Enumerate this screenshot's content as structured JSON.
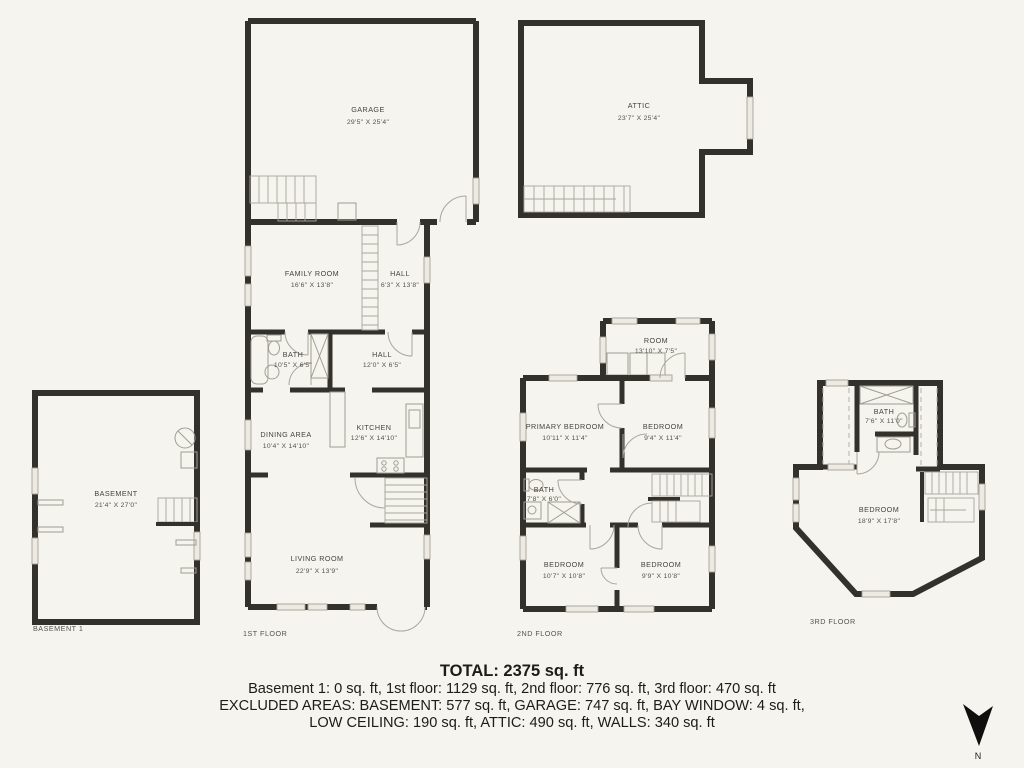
{
  "colors": {
    "background": "#f5f4ee",
    "wall": "#33312b",
    "fixture": "#a09e93",
    "window_fill": "#eceae1",
    "label_text": "#45443e"
  },
  "rooms": {
    "garage": {
      "name": "GARAGE",
      "dims": "29'5\" X 25'4\""
    },
    "attic": {
      "name": "ATTIC",
      "dims": "23'7\" X 25'4\""
    },
    "family_room": {
      "name": "FAMILY ROOM",
      "dims": "16'6\" X 13'8\""
    },
    "hall_upper": {
      "name": "HALL",
      "dims": "6'3\" X 13'8\""
    },
    "bath_1": {
      "name": "BATH",
      "dims": "10'5\" X 6'5\""
    },
    "hall_lower": {
      "name": "HALL",
      "dims": "12'0\" X 6'5\""
    },
    "dining": {
      "name": "DINING AREA",
      "dims": "10'4\" X 14'10\""
    },
    "kitchen": {
      "name": "KITCHEN",
      "dims": "12'6\" X 14'10\""
    },
    "living": {
      "name": "LIVING ROOM",
      "dims": "22'9\" X 13'9\""
    },
    "basement": {
      "name": "BASEMENT",
      "dims": "21'4\" X 27'0\""
    },
    "room_2f": {
      "name": "ROOM",
      "dims": "13'10\" X 7'5\""
    },
    "primary_bedroom": {
      "name": "PRIMARY BEDROOM",
      "dims": "10'11\" X 11'4\""
    },
    "bedroom_2f_ne": {
      "name": "BEDROOM",
      "dims": "9'4\" X 11'4\""
    },
    "bath_2": {
      "name": "BATH",
      "dims": "7'8\" X 6'0\""
    },
    "bedroom_2f_sw": {
      "name": "BEDROOM",
      "dims": "10'7\" X 10'8\""
    },
    "bedroom_2f_se": {
      "name": "BEDROOM",
      "dims": "9'9\" X 10'8\""
    },
    "bath_3": {
      "name": "BATH",
      "dims": "7'6\" X 11'0\""
    },
    "bedroom_3f": {
      "name": "BEDROOM",
      "dims": "18'9\" X 17'8\""
    }
  },
  "floor_labels": {
    "basement": "BASEMENT 1",
    "first": "1ST FLOOR",
    "second": "2ND FLOOR",
    "third": "3RD FLOOR"
  },
  "summary": {
    "total": "TOTAL: 2375 sq. ft",
    "line1": "Basement 1: 0 sq. ft, 1st floor: 1129 sq. ft, 2nd floor: 776 sq. ft, 3rd floor: 470 sq. ft",
    "line2": "EXCLUDED AREAS: BASEMENT: 577 sq. ft, GARAGE: 747 sq. ft, BAY WINDOW: 4 sq. ft,",
    "line3": "LOW CEILING: 190 sq. ft, ATTIC: 490 sq. ft, WALLS: 340 sq. ft"
  },
  "compass": {
    "label": "N"
  }
}
